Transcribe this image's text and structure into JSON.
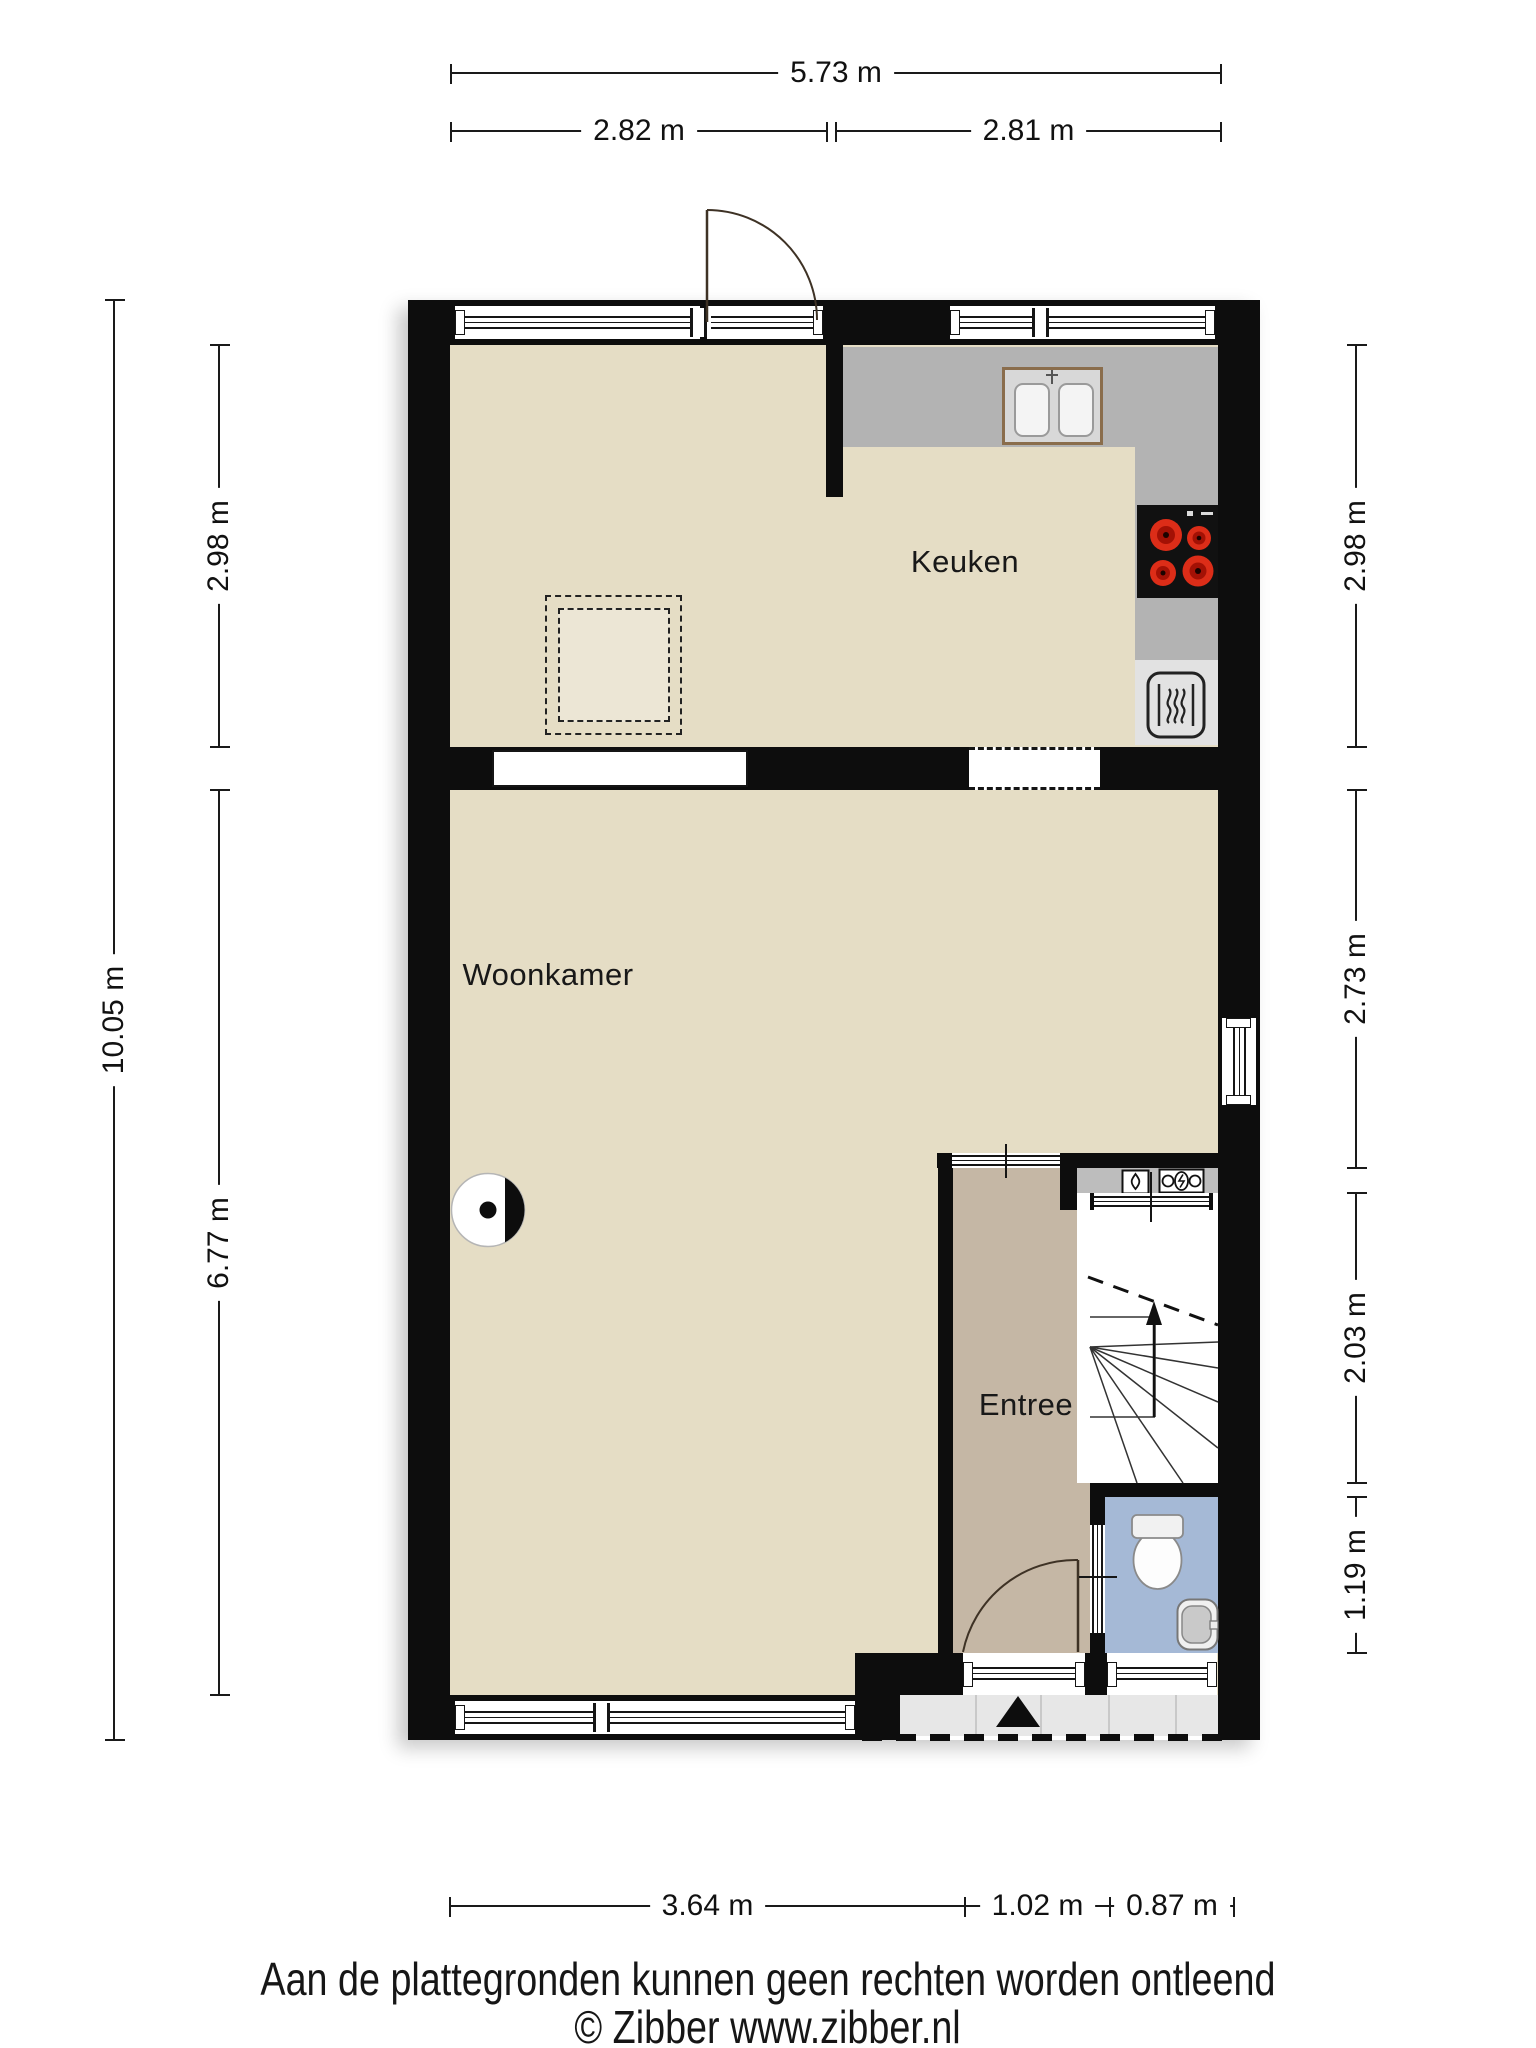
{
  "rooms": {
    "kitchen": "Keuken",
    "living": "Woonkamer",
    "hall": "Entree"
  },
  "dims": {
    "top_total": "5.73 m",
    "top_left": "2.82 m",
    "top_right": "2.81 m",
    "left_total": "10.05 m",
    "left_kitchen": "2.98 m",
    "left_living": "6.77 m",
    "right_kitchen": "2.98 m",
    "right_living": "2.73 m",
    "right_hall": "2.03 m",
    "right_toilet": "1.19 m",
    "bottom_living": "3.64 m",
    "bottom_entry": "1.02 m",
    "bottom_toilet": "0.87 m"
  },
  "footer": {
    "disclaimer": "Aan de plattegronden kunnen geen rechten worden ontleend",
    "copyright": "© Zibber www.zibber.nl"
  },
  "colors": {
    "wall": "#0d0d0d",
    "floor": "#e5ddc5",
    "hall_floor": "#c5b7a5",
    "toilet_floor": "#a5b9d6",
    "counter": "#b3b3b3",
    "appliance_panel": "#e2e2e2",
    "porch": "#e7e7e7",
    "burner_red": "#dc2d18",
    "sink_frame": "#8a6d4c"
  },
  "icons": [
    "chimney-icon",
    "hob-icon",
    "oven-icon",
    "sink-icon",
    "toilet-icon",
    "washbasin-icon",
    "water-meter-icon",
    "electricity-meter-icon",
    "stairs-up-arrow-icon",
    "entrance-arrow-icon",
    "door-swing-icon"
  ]
}
